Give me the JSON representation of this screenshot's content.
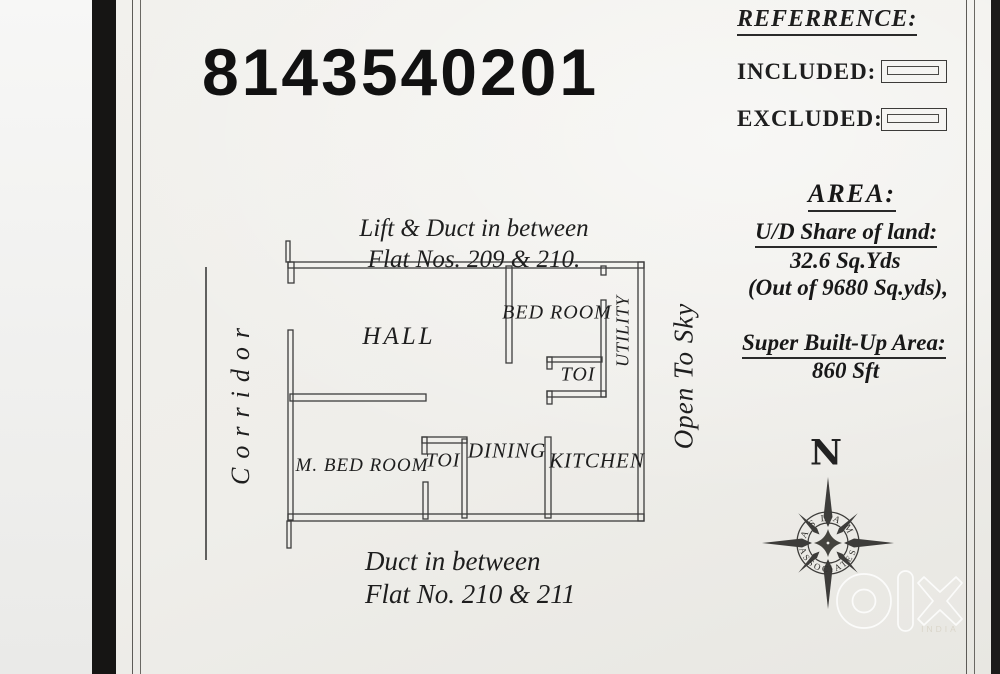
{
  "colors": {
    "paper": "#f0efeb",
    "ink": "#1e1e1e",
    "wall": "#3c3c3c",
    "band": "#161514",
    "watermark": "#ffffff"
  },
  "header": {
    "phone": "8143540201"
  },
  "notes": {
    "top_line1": "Lift & Duct in between",
    "top_line2": "Flat Nos. 209 & 210.",
    "bottom_line1": "Duct in between",
    "bottom_line2": "Flat No. 210 & 211"
  },
  "floor_plan": {
    "corridor_label": "Corridor",
    "open_to_sky_label": "Open To Sky",
    "rooms": [
      {
        "label": "HALL"
      },
      {
        "label": "BED ROOM"
      },
      {
        "label": "UTILITY"
      },
      {
        "label": "TOI"
      },
      {
        "label": "M. BED ROOM"
      },
      {
        "label": "TOI"
      },
      {
        "label": "DINING"
      },
      {
        "label": "KITCHEN"
      }
    ]
  },
  "reference": {
    "title": "REFERRENCE:",
    "included_label": "INCLUDED:",
    "excluded_label": "EXCLUDED:"
  },
  "area": {
    "title": "AREA:",
    "ud_share_label": "U/D Share of land:",
    "ud_share_value": "32.6 Sq.Yds",
    "ud_share_out_of": "(Out of 9680 Sq.yds),",
    "built_up_label": "Super Built-Up Area:",
    "built_up_value": "860 Sft"
  },
  "compass": {
    "north_label": "N",
    "ring_top": "ASLAM",
    "ring_bottom": "ASSOCIATES"
  },
  "watermark": {
    "country": "INDIA"
  }
}
